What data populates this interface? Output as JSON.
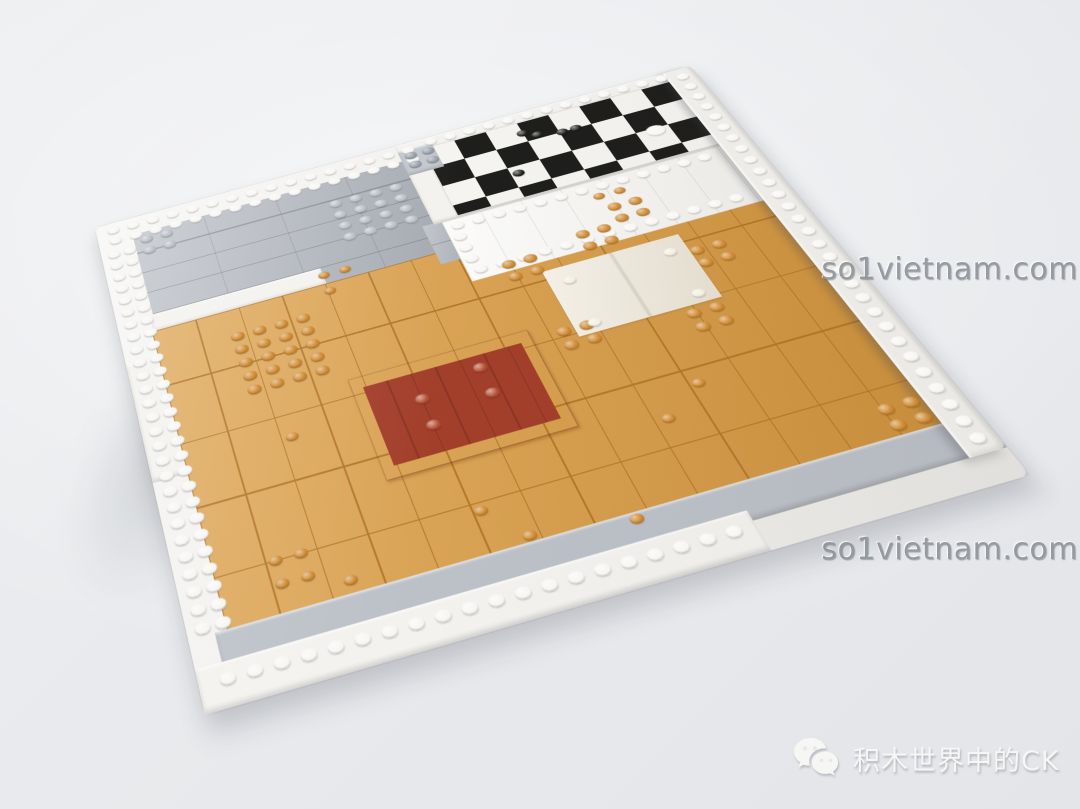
{
  "image_type": "photograph",
  "subject": "LEGO modular-building floor baseplate viewed at an angle on a light gray background",
  "watermarks": {
    "top_right": "so1vietnam.com",
    "middle_right": "so1vietnam.com"
  },
  "credit": {
    "icon": "wechat-icon",
    "text": "积木世界中的CK"
  },
  "colors": {
    "bg-top": "#eceef0",
    "bg-bottom": "#e3e5e9",
    "white-plate": "#f3f2ef",
    "white-tile": "#f8f7f4",
    "white-stud": "#f7f6f3",
    "light-gray": "#aeb3bb",
    "light-gray-block": "#c3c8ce",
    "gray-stud": "#b9bec5",
    "gray-dark-stud": "#989ea6",
    "plate-edge": "#bcc1c8",
    "orange-floor": "#d79a43",
    "orange-seam": "#b3782b",
    "orange-stud": "#cd8830",
    "dark-red": "#a23f2b",
    "dark-red-stud": "#b14b32",
    "cream": "#efe9da",
    "cream-stud": "#f3eee1",
    "checker-black": "#1e1e1c",
    "checker-white": "#f5f4f1",
    "watermark-gray": "#8d9399",
    "credit-white": "#f6f6f5"
  },
  "scene": {
    "regions": [
      {
        "name": "baseplate-base",
        "cls": "base",
        "x": 0,
        "y": 0,
        "w": 800,
        "h": 560,
        "color": "white-plate"
      },
      {
        "name": "gray-tiled-area",
        "cls": "seams-gray",
        "x": 44,
        "y": 26,
        "w": 356,
        "h": 148,
        "color": "light-gray"
      },
      {
        "name": "white-step-row",
        "cls": "edge",
        "x": 40,
        "y": 144,
        "w": 210,
        "h": 24,
        "color": "white-plate"
      },
      {
        "name": "white-step-left",
        "cls": "edge",
        "x": 0,
        "y": 200,
        "w": 56,
        "h": 140,
        "color": "white-plate"
      },
      {
        "name": "orange-floor",
        "cls": "seams-orange",
        "x": 38,
        "y": 166,
        "w": 728,
        "h": 352,
        "color": "orange-floor"
      },
      {
        "name": "gray-connector",
        "cls": "seams-gray",
        "x": 384,
        "y": 126,
        "w": 46,
        "h": 56,
        "color": "light-gray"
      },
      {
        "name": "checkerboard-frame",
        "cls": "edge",
        "x": 398,
        "y": 0,
        "w": 368,
        "h": 128,
        "color": "white-plate"
      },
      {
        "name": "checkerboard",
        "cls": "checker",
        "x": 430,
        "y": 16,
        "w": 336,
        "h": 108
      },
      {
        "name": "gray-utility-block",
        "cls": "edge",
        "x": 398,
        "y": 10,
        "w": 46,
        "h": 40,
        "color": "light-gray-block"
      },
      {
        "name": "white-tiled-room",
        "cls": "seams-room",
        "x": 408,
        "y": 128,
        "w": 358,
        "h": 86,
        "color": "white-tile"
      },
      {
        "name": "dark-red-rug",
        "cls": "rug",
        "x": 232,
        "y": 288,
        "w": 206,
        "h": 116
      },
      {
        "name": "cream-mat",
        "cls": "mat",
        "x": 486,
        "y": 226,
        "w": 164,
        "h": 86,
        "color": "cream"
      },
      {
        "name": "baseplate-bottom-edge",
        "cls": "edge",
        "x": 26,
        "y": 496,
        "w": 774,
        "h": 36,
        "color": "plate-edge"
      },
      {
        "name": "white-bottom-border",
        "cls": "edge",
        "x": 0,
        "y": 522,
        "w": 544,
        "h": 38,
        "color": "white-plate"
      },
      {
        "name": "white-right-wall",
        "cls": "wall",
        "x": 762,
        "y": 0,
        "w": 38,
        "h": 532,
        "color": "white-plate"
      },
      {
        "name": "lighting-glare",
        "cls": "glare",
        "x": 0,
        "y": 0,
        "w": 800,
        "h": 560
      }
    ],
    "stud_groups": [
      {
        "name": "white-border-studs-top",
        "x": 14,
        "y": 6,
        "cols": 16,
        "rows": 2,
        "px": 26,
        "py": 16,
        "color": "white-stud"
      },
      {
        "name": "white-border-studs-left",
        "x": 8,
        "y": 42,
        "cols": 2,
        "rows": 27,
        "px": 20,
        "py": 17,
        "color": "white-stud"
      },
      {
        "name": "white-border-studs-bottom",
        "x": 20,
        "y": 531,
        "cols": 20,
        "rows": 1,
        "px": 26,
        "py": 18,
        "color": "white-stud"
      },
      {
        "name": "checker-frame-studs",
        "x": 436,
        "y": 2,
        "cols": 13,
        "rows": 1,
        "px": 26,
        "py": 16,
        "color": "white-stud"
      },
      {
        "name": "room-studs-top",
        "x": 416,
        "y": 132,
        "cols": 13,
        "rows": 1,
        "px": 26,
        "py": 16,
        "color": "white-stud"
      },
      {
        "name": "room-studs-bottom",
        "x": 416,
        "y": 196,
        "cols": 13,
        "rows": 1,
        "px": 26,
        "py": 16,
        "color": "white-stud"
      },
      {
        "name": "room-studs-left",
        "x": 412,
        "y": 148,
        "cols": 1,
        "rows": 3,
        "px": 26,
        "py": 16,
        "color": "white-stud"
      },
      {
        "name": "wall-studs",
        "x": 774,
        "y": 8,
        "cols": 1,
        "rows": 29,
        "px": 26,
        "py": 18,
        "color": "white-stud"
      },
      {
        "name": "gray-2x2-studs",
        "x": 52,
        "y": 32,
        "cols": 2,
        "rows": 2,
        "px": 26,
        "py": 17,
        "color": "gray-stud"
      },
      {
        "name": "gray-plate-studs",
        "x": 290,
        "y": 56,
        "cols": 4,
        "rows": 4,
        "px": 26,
        "py": 17,
        "color": "gray-stud"
      },
      {
        "name": "gray-block-studs",
        "x": 404,
        "y": 15,
        "cols": 2,
        "rows": 2,
        "px": 23,
        "py": 15,
        "color": "gray-dark-stud"
      },
      {
        "name": "orange-plate-studs",
        "x": 124,
        "y": 196,
        "cols": 4,
        "rows": 5,
        "px": 26,
        "py": 17,
        "color": "orange-stud"
      },
      {
        "name": "orange-studs-nw-of-mat",
        "x": 448,
        "y": 200,
        "cols": 2,
        "rows": 2,
        "px": 26,
        "py": 17,
        "color": "orange-stud"
      },
      {
        "name": "orange-studs-n-of-mat",
        "x": 544,
        "y": 188,
        "cols": 2,
        "rows": 2,
        "px": 26,
        "py": 17,
        "color": "orange-stud"
      },
      {
        "name": "orange-studs-ne-of-mat",
        "x": 650,
        "y": 246,
        "cols": 2,
        "rows": 2,
        "px": 26,
        "py": 17,
        "color": "orange-stud"
      },
      {
        "name": "orange-studs-sw-of-mat",
        "x": 466,
        "y": 296,
        "cols": 2,
        "rows": 2,
        "px": 26,
        "py": 17,
        "color": "orange-stud"
      },
      {
        "name": "orange-studs-se-of-mat",
        "x": 604,
        "y": 316,
        "cols": 2,
        "rows": 2,
        "px": 26,
        "py": 17,
        "color": "orange-stud"
      },
      {
        "name": "orange-studs-upper-right",
        "x": 596,
        "y": 164,
        "cols": 2,
        "rows": 2,
        "px": 26,
        "py": 17,
        "color": "orange-stud"
      },
      {
        "name": "orange-studs-corner",
        "x": 716,
        "y": 464,
        "cols": 2,
        "rows": 2,
        "px": 26,
        "py": 17,
        "color": "orange-stud"
      },
      {
        "name": "rug-studs-left-pair",
        "x": 292,
        "y": 326,
        "cols": 1,
        "rows": 2,
        "px": 26,
        "py": 30,
        "color": "dark-red-stud"
      },
      {
        "name": "rug-studs-right-pair",
        "x": 364,
        "y": 310,
        "cols": 1,
        "rows": 2,
        "px": 26,
        "py": 30,
        "color": "dark-red-stud"
      },
      {
        "name": "cream-mat-corner-studs",
        "x": 502,
        "y": 240,
        "cols": 2,
        "rows": 2,
        "px": 120,
        "py": 56,
        "d": 15,
        "dv": 10,
        "color": "cream-stud"
      },
      {
        "name": "round-stud",
        "x": 148,
        "y": 328,
        "cols": 1,
        "rows": 1,
        "d": 14,
        "dv": 9,
        "color": "orange-stud"
      },
      {
        "name": "round-stud-cluster",
        "x": 94,
        "y": 444,
        "cols": 2,
        "rows": 2,
        "px": 26,
        "py": 22,
        "d": 14,
        "dv": 9,
        "color": "orange-stud"
      },
      {
        "name": "round-stud",
        "x": 158,
        "y": 480,
        "cols": 1,
        "rows": 1,
        "d": 14,
        "dv": 9,
        "color": "orange-stud"
      },
      {
        "name": "round-stud",
        "x": 302,
        "y": 452,
        "cols": 1,
        "rows": 1,
        "d": 14,
        "dv": 9,
        "color": "orange-stud"
      },
      {
        "name": "round-stud",
        "x": 336,
        "y": 486,
        "cols": 1,
        "rows": 1,
        "d": 14,
        "dv": 9,
        "color": "orange-stud"
      },
      {
        "name": "round-stud",
        "x": 438,
        "y": 498,
        "cols": 1,
        "rows": 1,
        "d": 14,
        "dv": 9,
        "color": "orange-stud"
      },
      {
        "name": "round-stud",
        "x": 518,
        "y": 416,
        "cols": 1,
        "rows": 1,
        "d": 14,
        "dv": 9,
        "color": "orange-stud"
      },
      {
        "name": "round-stud",
        "x": 566,
        "y": 390,
        "cols": 1,
        "rows": 1,
        "d": 14,
        "dv": 9,
        "color": "orange-stud"
      },
      {
        "name": "round-stud-pair",
        "x": 244,
        "y": 150,
        "cols": 2,
        "rows": 1,
        "px": 26,
        "py": 22,
        "d": 14,
        "dv": 9,
        "color": "orange-stud"
      },
      {
        "name": "round-stud",
        "x": 244,
        "y": 172,
        "cols": 1,
        "rows": 1,
        "d": 14,
        "dv": 9,
        "color": "orange-stud"
      },
      {
        "name": "round-stud-pair",
        "x": 588,
        "y": 146,
        "cols": 2,
        "rows": 1,
        "px": 26,
        "py": 22,
        "d": 14,
        "dv": 9,
        "color": "orange-stud"
      },
      {
        "name": "black-stud",
        "x": 548,
        "y": 28,
        "cols": 1,
        "rows": 1,
        "d": 15,
        "dv": 10,
        "color": "checker-black"
      },
      {
        "name": "black-stud",
        "x": 564,
        "y": 36,
        "cols": 1,
        "rows": 1,
        "d": 15,
        "dv": 10,
        "color": "checker-black"
      },
      {
        "name": "black-stud-pair",
        "x": 594,
        "y": 42,
        "cols": 2,
        "rows": 1,
        "px": 18,
        "py": 16,
        "d": 15,
        "dv": 10,
        "color": "checker-black"
      },
      {
        "name": "black-stud",
        "x": 516,
        "y": 84,
        "cols": 1,
        "rows": 1,
        "d": 15,
        "dv": 10,
        "color": "checker-black"
      },
      {
        "name": "white-round-dish",
        "x": 694,
        "y": 74,
        "cols": 1,
        "rows": 1,
        "d": 24,
        "dv": 16,
        "color": "white-stud"
      }
    ]
  }
}
